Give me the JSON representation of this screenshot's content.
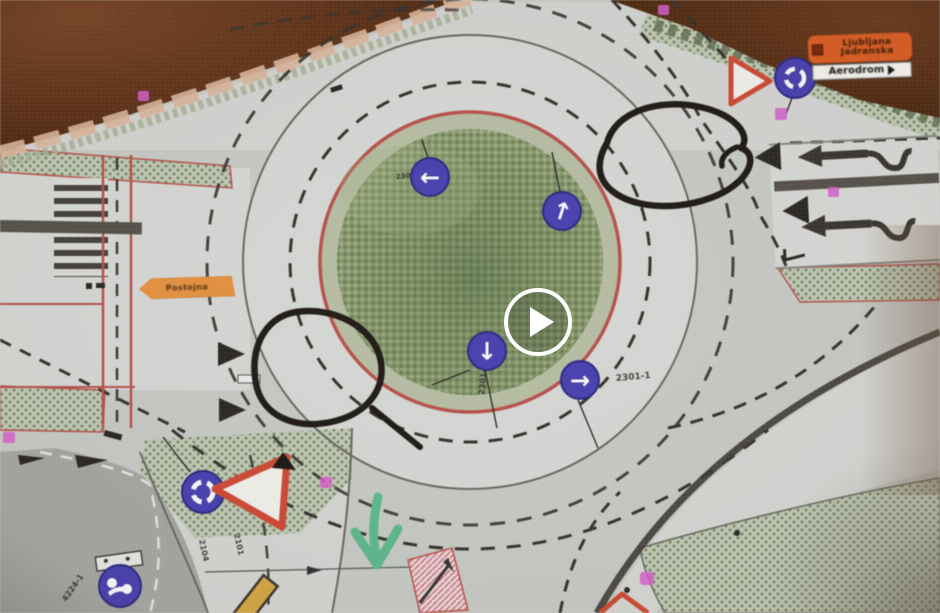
{
  "video": {
    "play_icon": "play"
  },
  "plan": {
    "signs": {
      "mandatory_left": {
        "glyph": "←"
      },
      "mandatory_up": {
        "glyph": "↑"
      },
      "mandatory_down": {
        "glyph": "↓",
        "code": "2301-1"
      },
      "mandatory_right": {
        "glyph": "→",
        "code": "2301-1"
      },
      "island_code": "2301",
      "roundabout_bottom": {
        "code_a": "2101",
        "code_b": "2104"
      },
      "shared_path": {
        "code": "4224-1"
      }
    },
    "direction_board": {
      "line1": "Ljubljana",
      "line2": "Jadranska",
      "secondary": "Aerodrom"
    },
    "street_arrow_sign": {
      "text": "Postojna"
    },
    "colors": {
      "sign_blue": "#4a41b8",
      "sign_blue_edge": "#2e2a86",
      "yield_red": "#d84a32",
      "board_orange": "#dd5a1f",
      "marker_green": "#5cbd8e",
      "annotation_black": "#211c18",
      "magenta": "#df5fd4",
      "grass_green": "#8a9b6b",
      "island_edge_red": "#c0504a"
    }
  }
}
